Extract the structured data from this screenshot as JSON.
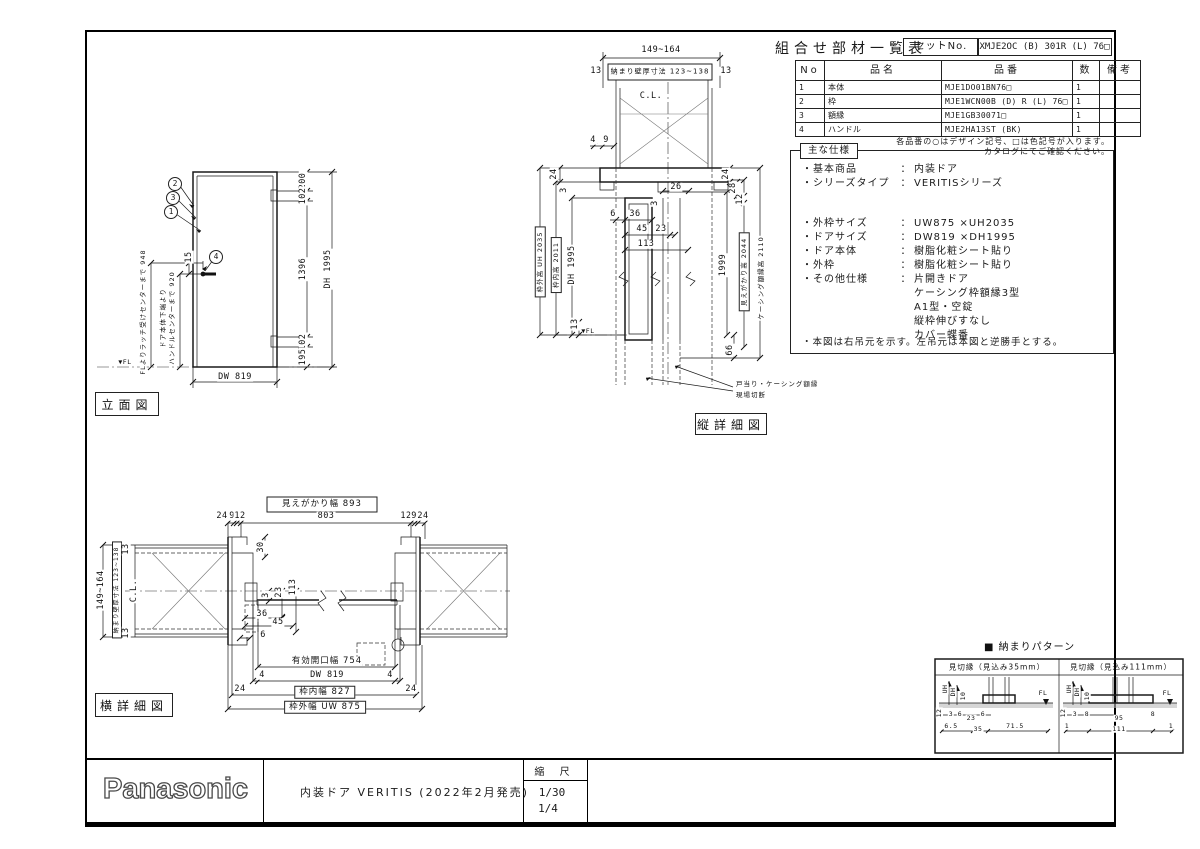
{
  "parts_table": {
    "title": "組合せ部材一覧表",
    "set_no_label": "セットNo.",
    "set_no_value": "XMJE2OC (B) 301R (L) 76□",
    "col_no": "No",
    "col_name": "品名",
    "col_part": "品番",
    "col_qty": "数",
    "col_remarks": "備考",
    "rows": [
      {
        "no": "1",
        "name": "本体",
        "part": "MJE1DO01BN76□",
        "qty": "1",
        "remarks": ""
      },
      {
        "no": "2",
        "name": "枠",
        "part": "MJE1WCN00B (D) R (L) 76□",
        "qty": "1",
        "remarks": ""
      },
      {
        "no": "3",
        "name": "額縁",
        "part": "MJE1GB30071□",
        "qty": "1",
        "remarks": ""
      },
      {
        "no": "4",
        "name": "ハンドル",
        "part": "MJE2HA13ST (BK)",
        "qty": "1",
        "remarks": ""
      }
    ],
    "note1": "各品番の○はデザイン記号、□は色記号が入ります。",
    "note2": "カタログにてご確認ください。"
  },
  "specs": {
    "box_label": "主な仕様",
    "rows": [
      {
        "label": "・基本商品",
        "colon": "：",
        "value": "内装ドア"
      },
      {
        "label": "・シリーズタイプ",
        "colon": "：",
        "value": "VERITISシリーズ"
      },
      {
        "label": "・外枠サイズ",
        "colon": "：",
        "value": "UW875 ×UH2035"
      },
      {
        "label": "・ドアサイズ",
        "colon": "：",
        "value": "DW819 ×DH1995"
      },
      {
        "label": "・ドア本体",
        "colon": "：",
        "value": "樹脂化粧シート貼り"
      },
      {
        "label": "・外枠",
        "colon": "：",
        "value": "樹脂化粧シート貼り"
      },
      {
        "label": "・その他仕様",
        "colon": "：",
        "value": "片開きドア"
      }
    ],
    "extra": [
      "ケーシング枠額縁3型",
      "A1型・空錠",
      "縦枠伸びすなし",
      "カバー蝶番"
    ],
    "footnote": "・本図は右吊元を示す。左吊元は本図と逆勝手とする。"
  },
  "elev": {
    "label": "立面図",
    "balloon_2": "2",
    "balloon_3": "3",
    "balloon_1": "1",
    "balloon_4": "4",
    "dim_15": "15",
    "latch_text": "FLよりラッチ受けセンターまで 948",
    "handle_text1": "ドア本体下端より",
    "handle_text2": "ハンドルセンターまで 920",
    "fl": "▼FL",
    "chain": [
      "200",
      "102",
      "1396",
      "102",
      "195"
    ],
    "dh": "DH 1995",
    "dw": "DW 819"
  },
  "vsec": {
    "label": "縦詳細図",
    "top_dim": "149~164",
    "wall_dim": "納まり壁厚寸法 123~138",
    "d13l": "13",
    "d13r": "13",
    "cl": "C.L.",
    "d4": "4",
    "d9": "9",
    "d24l": "24",
    "d3l": "3",
    "d24r": "24",
    "d28": "28",
    "d12": "12",
    "d26": "26",
    "d6": "6",
    "d36": "36",
    "d45": "45",
    "d23": "23",
    "d3i": "3",
    "d113": "113",
    "uh": "枠外高 UH 2035",
    "inner_h": "枠内高 2011",
    "dh": "DH 1995",
    "d1999": "1999",
    "mie": "見えがかり高 2044",
    "casing": "ケーシング額縁高 2110",
    "d13f": "13",
    "fl": "▼FL",
    "d66": "66",
    "note1": "戸当り・ケーシング額縁",
    "note2": "現場切断"
  },
  "hsec": {
    "label": "横詳細図",
    "left_dim": "149~164",
    "wall_dim": "納まり壁厚寸法 123~138",
    "d13t": "13",
    "d13b": "13",
    "cl": "C.L.",
    "mie_w": "見えがかり幅 893",
    "top_chain": [
      "24",
      "9",
      "12",
      "803",
      "12",
      "9",
      "24"
    ],
    "d30": "30",
    "d3": "3",
    "d23": "23",
    "d113": "113",
    "d36": "36",
    "d45": "45",
    "d6": "6",
    "eff_w": "有効開口幅 754",
    "d4l": "4",
    "dw": "DW 819",
    "d4r": "4",
    "d24l": "24",
    "inner_w": "枠内幅 827",
    "d24r": "24",
    "outer_w": "枠外幅 UW 875"
  },
  "osamari": {
    "title": "■ 納まりパターン",
    "p1": {
      "header": "見切縁（見込み35mm）",
      "uh": "UH",
      "dh": "DH",
      "d10": "10",
      "d12": "12",
      "d3": "3",
      "d6a": "6",
      "d23": "23",
      "d6b": "6",
      "b1": "6.5",
      "b2": "35",
      "b3": "71.5",
      "fl": "FL"
    },
    "p2": {
      "header": "見切縁（見込み111mm）",
      "uh": "UH",
      "dh": "DH",
      "d10": "10",
      "d12": "12",
      "d3": "3",
      "d8a": "8",
      "d95": "95",
      "d8b": "8",
      "b1": "1",
      "b2": "111",
      "b3": "1",
      "fl": "FL"
    }
  },
  "title_block": {
    "brand": "Panasonic",
    "description": "内装ドア VERITIS (2022年2月発売)",
    "scale_label": "縮 尺",
    "scale1": "1/30",
    "scale2": "1/4"
  }
}
